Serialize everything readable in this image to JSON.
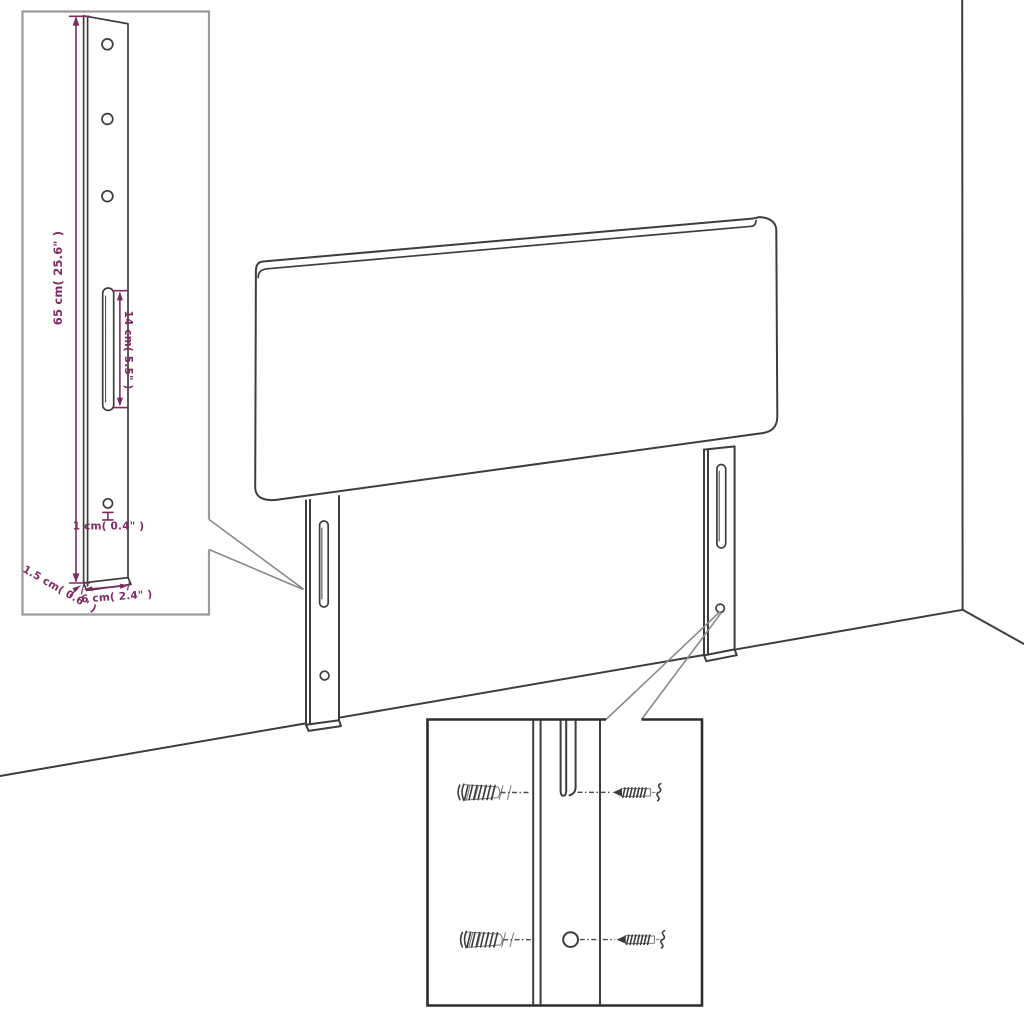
{
  "diagram": {
    "subject": "headboard-with-mounting-legs-dimension-diagram",
    "labels": {
      "leg_height": "65 cm( 25.6\" )",
      "slot_length": "14 cm( 5.5\" )",
      "hole_size": "1 cm( 0.4\" )",
      "leg_thickness": "1.5 cm( 0.6\" )",
      "leg_width": "6 cm( 2.4\" )"
    },
    "colors": {
      "background": "#ffffff",
      "line_art": "#3d3d3d",
      "dimension": "#7f2a63",
      "inset_border_light": "#9b9b9b",
      "inset_border_dark": "#2d2d2d",
      "leader_line": "#8a8a8a"
    }
  }
}
